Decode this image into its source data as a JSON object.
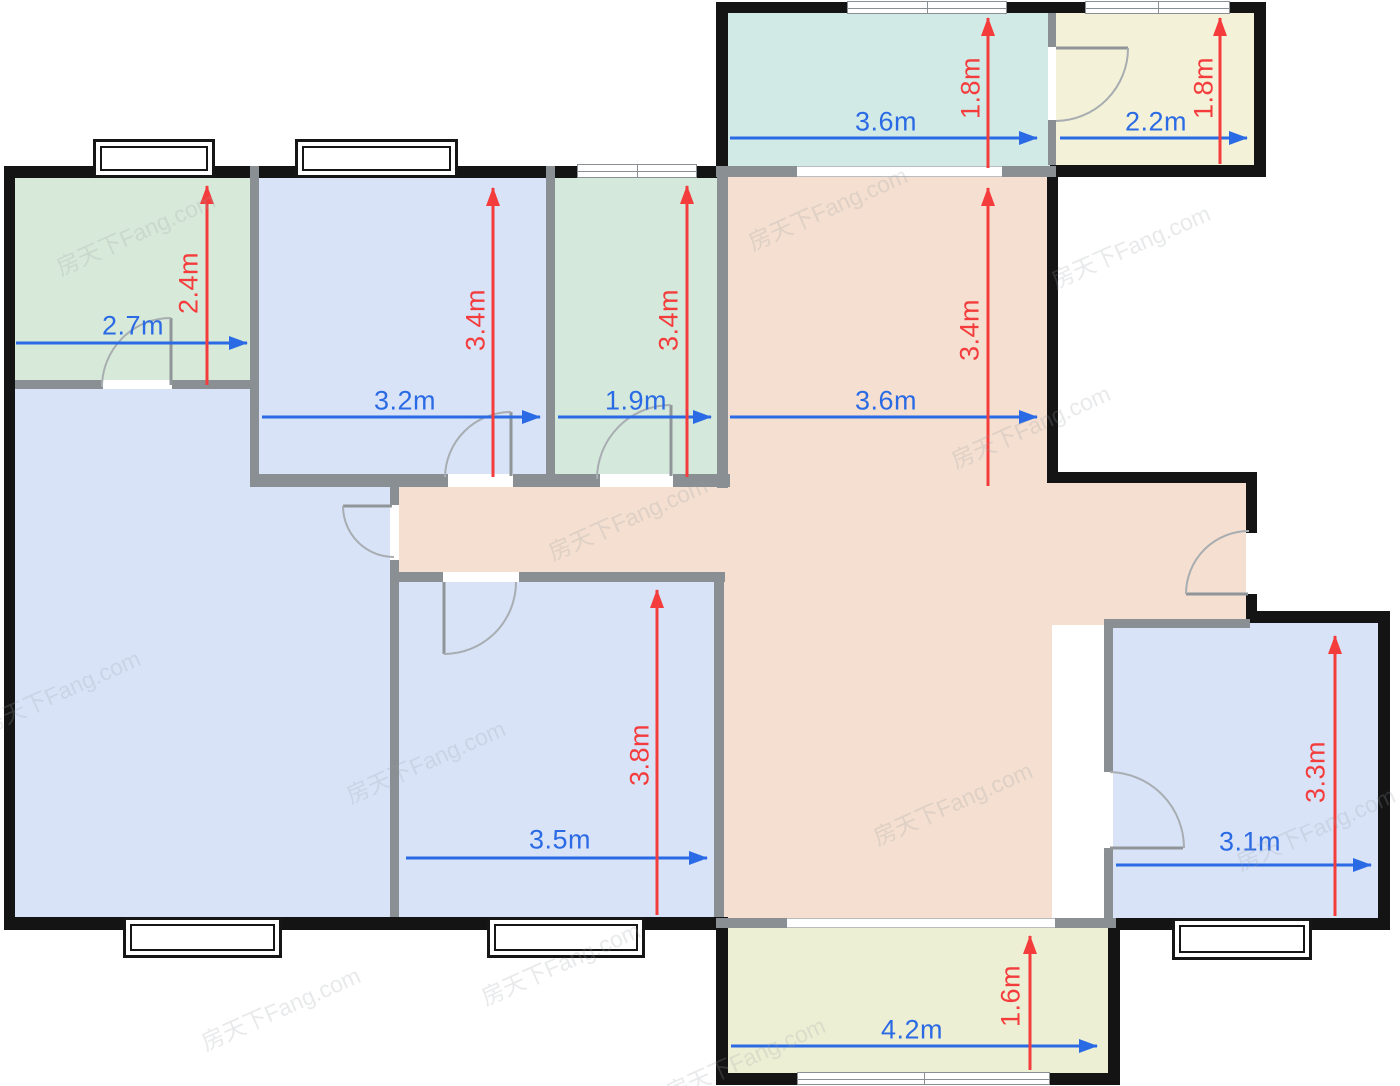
{
  "watermark": {
    "text": "房天下Fang.com"
  },
  "palette": {
    "wall_outer": "#141414",
    "wall_inner": "#8a8f93",
    "dim_blue": "#2a6ae4",
    "dim_red": "#f43c3c",
    "room_green": "#d7ead9",
    "room_mint": "#d4e9dc",
    "room_blue": "#d8e3f8",
    "room_tan": "#f4dfd0",
    "room_teal": "#d2eae6",
    "room_yellow": "#f3f1d7",
    "room_balcony": "#edefd4"
  },
  "rooms": [
    {
      "id": "bedroom-top-left",
      "fill": "#d7ead9",
      "width": "2.7m",
      "height": "2.4m"
    },
    {
      "id": "bedroom-top-middle",
      "fill": "#d8e3f8",
      "width": "3.2m",
      "height": "3.4m"
    },
    {
      "id": "room-top-small",
      "fill": "#d4e9dc",
      "width": "1.9m",
      "height": "3.4m"
    },
    {
      "id": "living-dining",
      "fill": "#f4dfd0",
      "width": "3.6m",
      "height": "3.4m"
    },
    {
      "id": "balcony-top",
      "fill": "#d2eae6",
      "width": "3.6m",
      "height": "1.8m"
    },
    {
      "id": "bathroom-top-right",
      "fill": "#f3f1d7",
      "width": "2.2m",
      "height": "1.8m"
    },
    {
      "id": "bedroom-bottom-middle",
      "fill": "#d8e3f8",
      "width": "3.5m",
      "height": "3.8m"
    },
    {
      "id": "bedroom-bottom-right",
      "fill": "#d8e3f8",
      "width": "3.1m",
      "height": "3.3m"
    },
    {
      "id": "balcony-bottom",
      "fill": "#edefd4",
      "width": "4.2m",
      "height": "1.6m"
    },
    {
      "id": "room-big-left",
      "fill": "#d8e3f8"
    }
  ]
}
